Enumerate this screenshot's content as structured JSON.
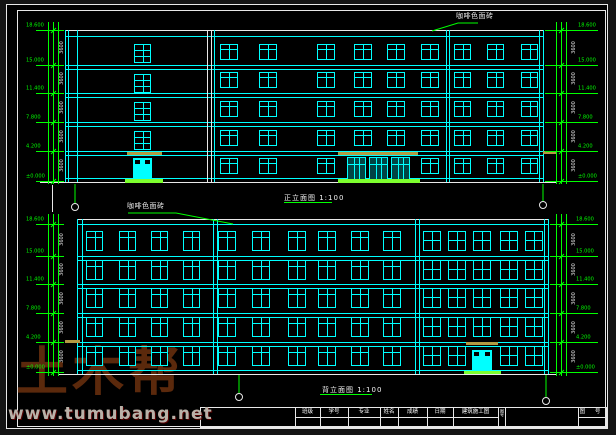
{
  "watermark": {
    "brand": "土木帮",
    "site": "www.tumubang.net"
  },
  "titles": {
    "front": "正立面图 1:100",
    "back": "背立面图 1:100"
  },
  "notes": {
    "front": "咖啡色面砖",
    "back": "咖啡色面砖"
  },
  "level_values": [
    "18.600",
    "15.000",
    "11.400",
    "7.800",
    "4.200",
    "±0.000"
  ],
  "dim_value": "3600",
  "colors": {
    "cyan": "#00ffff",
    "green": "#00ff00",
    "bright_green": "#7dff2e",
    "white": "#e8e8e8",
    "olive": "#b49a42"
  },
  "title_block": {
    "fields": [
      {
        "label": "班级"
      },
      {
        "label": "学号"
      },
      {
        "label": "专业"
      },
      {
        "label": "姓名"
      },
      {
        "label": "成绩"
      },
      {
        "label": "日期"
      },
      {
        "label": "建筑施工图"
      }
    ],
    "side_label": "图号",
    "right_label": "图 号"
  },
  "elevations": [
    {
      "name": "front-elevation",
      "outline": {
        "left": 65,
        "right": 543,
        "top_white": 30,
        "top_cyan": 36,
        "ground_cyan": 178,
        "ground_white": 182,
        "gw_x1": 40,
        "gw_x2": 557
      },
      "verticals_cyan": [
        65,
        68,
        77,
        214,
        446,
        449,
        539,
        543
      ],
      "verticals_white": [
        207,
        211
      ],
      "floor_lines": [
        65,
        93,
        122,
        151
      ],
      "window_groups": [
        {
          "type": "transom",
          "w": 18,
          "h": 16,
          "rows": [
            44,
            72,
            101,
            130
          ],
          "cols": [
            220,
            259,
            317,
            354,
            387,
            421
          ]
        },
        {
          "type": "transom",
          "w": 18,
          "h": 16,
          "rows": [
            158
          ],
          "cols": [
            220,
            259,
            317,
            421
          ]
        },
        {
          "type": "transom",
          "w": 17,
          "h": 16,
          "rows": [
            44,
            72,
            101,
            130,
            158
          ],
          "cols": [
            454,
            487,
            521
          ]
        },
        {
          "type": "tall",
          "w": 17,
          "h": 19,
          "rows": [
            44,
            74,
            102,
            131
          ],
          "cols": [
            134
          ]
        }
      ],
      "doors": [
        {
          "x": 133,
          "w": 19,
          "y": 158,
          "h": 23
        }
      ],
      "entrance": {
        "x": 347,
        "units": 3,
        "unit_w": 19,
        "gap": 3,
        "y": 157,
        "h": 24
      },
      "canopies": [
        {
          "x": 127,
          "y": 152,
          "w": 35
        },
        {
          "x": 338,
          "y": 152,
          "w": 80
        },
        {
          "x": 543,
          "y": 151,
          "w": 14
        }
      ],
      "steps": [
        {
          "x": 125,
          "y": 179,
          "w": 38,
          "h": 4
        },
        {
          "x": 338,
          "y": 179,
          "w": 82,
          "h": 4
        }
      ],
      "dim_left": {
        "lines": [
          48,
          53,
          58
        ],
        "y1": 22,
        "y2": 184,
        "level_ys": [
          30,
          65,
          93,
          122,
          151,
          181
        ],
        "label_x": 26,
        "text_x": 56,
        "ext_x1": 36,
        "ext_x2": 64
      },
      "dim_right": {
        "lines": [
          556,
          561,
          566
        ],
        "y1": 22,
        "y2": 184,
        "level_ys": [
          30,
          65,
          93,
          122,
          151,
          181
        ],
        "label_x": 578,
        "text_x": 568,
        "ext_x1": 545,
        "ext_x2": 598
      },
      "axis": [
        {
          "x": 75,
          "sy1": 184,
          "sy2": 203,
          "cy": 207
        },
        {
          "x": 543,
          "sy1": 184,
          "sy2": 201,
          "cy": 205
        }
      ],
      "label_pos": {
        "x": 284,
        "y": 193,
        "ul_w": 48
      },
      "note_pos": {
        "x": 456,
        "y": 11
      },
      "leader": [
        [
          478,
          23
        ],
        [
          458,
          23
        ],
        [
          432,
          31
        ]
      ],
      "extra_white_lines": [
        {
          "x": 52,
          "y": 185,
          "h": 27
        }
      ]
    },
    {
      "name": "back-elevation",
      "outline": {
        "left": 77,
        "right": 548,
        "top_white": 219,
        "top_cyan": 224,
        "ground_cyan": 370,
        "ground_white": 374,
        "gw_x1": 58,
        "gw_x2": 557
      },
      "verticals_cyan": [
        77,
        82,
        213,
        217,
        415,
        419,
        544,
        548
      ],
      "verticals_white": [],
      "floor_lines": [
        256,
        284,
        313,
        342
      ],
      "window_groups": [
        {
          "type": "transom",
          "w": 17,
          "h": 20,
          "rows": [
            231,
            260,
            288,
            317,
            346
          ],
          "cols": [
            86,
            119,
            151,
            183
          ]
        },
        {
          "type": "transom",
          "w": 18,
          "h": 20,
          "rows": [
            231,
            260,
            288,
            317,
            346
          ],
          "cols": [
            218,
            252,
            288,
            318,
            351,
            383
          ]
        },
        {
          "type": "grid",
          "w": 18,
          "h": 20,
          "rows": [
            231,
            260,
            288,
            317,
            346
          ],
          "cols": [
            423,
            448,
            500,
            525
          ]
        },
        {
          "type": "grid",
          "w": 18,
          "h": 20,
          "rows": [
            231,
            260,
            288,
            317
          ],
          "cols": [
            473
          ]
        }
      ],
      "doors": [
        {
          "x": 472,
          "w": 20,
          "y": 350,
          "h": 22
        }
      ],
      "entrance": null,
      "canopies": [
        {
          "x": 65,
          "y": 340,
          "w": 15
        },
        {
          "x": 466,
          "y": 342,
          "w": 32
        }
      ],
      "steps": [
        {
          "x": 464,
          "y": 371,
          "w": 37,
          "h": 3
        }
      ],
      "dim_left": {
        "lines": [
          48,
          53,
          58
        ],
        "y1": 214,
        "y2": 376,
        "level_ys": [
          224,
          256,
          284,
          313,
          342,
          372
        ],
        "label_x": 26,
        "text_x": 56,
        "ext_x1": 36,
        "ext_x2": 64
      },
      "dim_right": {
        "lines": [
          556,
          561,
          566
        ],
        "y1": 214,
        "y2": 376,
        "level_ys": [
          224,
          256,
          284,
          313,
          342,
          372
        ],
        "label_x": 576,
        "text_x": 568,
        "ext_x1": 550,
        "ext_x2": 598
      },
      "axis": [
        {
          "x": 239,
          "sy1": 375,
          "sy2": 393,
          "cy": 397
        },
        {
          "x": 546,
          "sy1": 375,
          "sy2": 397,
          "cy": 401
        }
      ],
      "label_pos": {
        "x": 322,
        "y": 385,
        "ul_w": 52
      },
      "note_pos": {
        "x": 127,
        "y": 201
      },
      "leader": [
        [
          128,
          213
        ],
        [
          176,
          213
        ],
        [
          233,
          224
        ]
      ],
      "extra_white_lines": []
    }
  ],
  "title_block_geom": {
    "x": 200,
    "y": 407,
    "x2": 606,
    "y2": 427,
    "row_y": 417,
    "col_xs": [
      295,
      320,
      348,
      380,
      398,
      427,
      453,
      498,
      505,
      578
    ],
    "mid_segments": [
      [
        295,
        498
      ],
      [
        578,
        606
      ]
    ]
  }
}
